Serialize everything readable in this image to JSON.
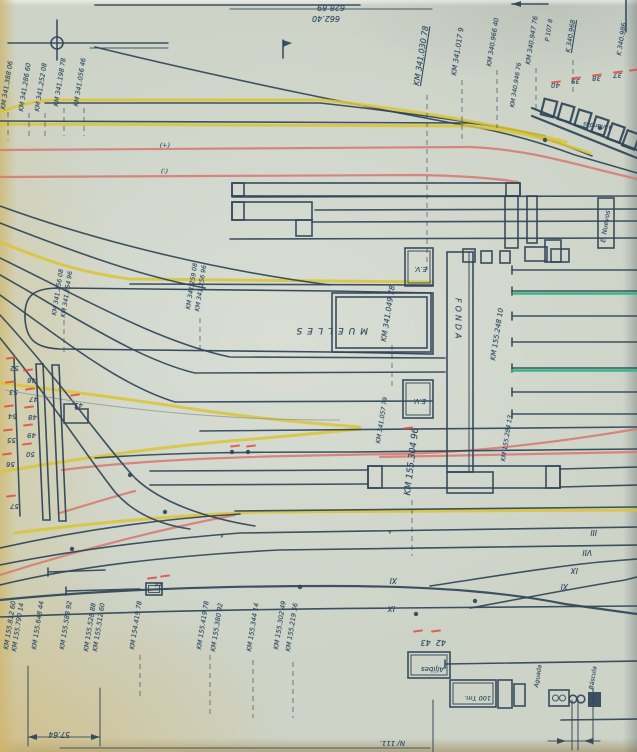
{
  "colors": {
    "ink": "#2e4a63",
    "track": "#2f4558",
    "yellow": "#d9c435",
    "salmon": "#d67c74",
    "red_mark": "#e04b44",
    "green": "#2fb383",
    "paper": "#cdd3c7",
    "pencil": "#8e9894"
  },
  "labels": [
    {
      "n": "dimension-value",
      "t": "628.89",
      "x": 345,
      "y": 11,
      "r": 180,
      "fs": 8
    },
    {
      "n": "dimension-value",
      "t": "662.40",
      "x": 340,
      "y": 22,
      "r": 180,
      "fs": 8
    },
    {
      "n": "km-marker",
      "t": "KM 341.388 06",
      "x": 0,
      "y": 109,
      "r": 279,
      "fs": 6.5
    },
    {
      "n": "km-marker",
      "t": "KM 341.286 60",
      "x": 18,
      "y": 111,
      "r": 279,
      "fs": 6.5
    },
    {
      "n": "km-marker",
      "t": "KM 341.252 08",
      "x": 34,
      "y": 111,
      "r": 279,
      "fs": 6.5
    },
    {
      "n": "km-marker",
      "t": "KM 341.198 78",
      "x": 53,
      "y": 106,
      "r": 279,
      "fs": 6.5
    },
    {
      "n": "km-marker",
      "t": "KM 341.056 46",
      "x": 73,
      "y": 106,
      "r": 279,
      "fs": 6.5
    },
    {
      "n": "km-marker",
      "t": "KM 341.030 78",
      "x": 413,
      "y": 85,
      "r": 279,
      "fs": 8,
      "u": true
    },
    {
      "n": "km-marker",
      "t": "KM 341.017 9",
      "x": 451,
      "y": 75,
      "r": 279,
      "fs": 7
    },
    {
      "n": "km-marker",
      "t": "KM 340.966 40",
      "x": 486,
      "y": 66,
      "r": 279,
      "fs": 6.5
    },
    {
      "n": "km-marker",
      "t": "KM 340.947 76",
      "x": 525,
      "y": 64,
      "r": 279,
      "fs": 6.5
    },
    {
      "n": "note",
      "t": "P 107 8",
      "x": 545,
      "y": 41,
      "r": 279,
      "fs": 6
    },
    {
      "n": "km-marker",
      "t": "K 340.968",
      "x": 565,
      "y": 52,
      "r": 279,
      "fs": 6.5,
      "u": true
    },
    {
      "n": "km-marker",
      "t": "KM 340.946 76",
      "x": 510,
      "y": 107,
      "r": 279,
      "fs": 6
    },
    {
      "n": "km-marker",
      "t": "K 340.986",
      "x": 616,
      "y": 55,
      "r": 279,
      "fs": 6.5
    },
    {
      "n": "destination-note",
      "t": "a Viandas",
      "x": 612,
      "y": 130,
      "r": 188,
      "fs": 6
    },
    {
      "n": "pier-number",
      "t": "40",
      "x": 560,
      "y": 88,
      "r": 180,
      "fs": 7
    },
    {
      "n": "pier-number",
      "t": "39",
      "x": 580,
      "y": 84,
      "r": 180,
      "fs": 7
    },
    {
      "n": "pier-number",
      "t": "38",
      "x": 601,
      "y": 81,
      "r": 180,
      "fs": 7
    },
    {
      "n": "pier-number",
      "t": "37",
      "x": 622,
      "y": 78,
      "r": 180,
      "fs": 7
    },
    {
      "n": "hand-mark",
      "t": "(+)",
      "x": 170,
      "y": 148,
      "r": 180,
      "fs": 6.5
    },
    {
      "n": "hand-mark",
      "t": "(:)",
      "x": 168,
      "y": 174,
      "r": 180,
      "fs": 6.5
    },
    {
      "n": "km-marker",
      "t": "KM 341.256 08",
      "x": 52,
      "y": 315,
      "r": 279,
      "fs": 6.2
    },
    {
      "n": "km-marker",
      "t": "KM 341.254 96",
      "x": 61,
      "y": 317,
      "r": 279,
      "fs": 6.2
    },
    {
      "n": "km-marker",
      "t": "KM 341.259 08",
      "x": 186,
      "y": 309,
      "r": 279,
      "fs": 6.2
    },
    {
      "n": "km-marker",
      "t": "KM 341.256 96",
      "x": 195,
      "y": 311,
      "r": 279,
      "fs": 6.2
    },
    {
      "n": "muelles-label",
      "t": "MUELLES",
      "x": 368,
      "y": 334,
      "r": 180,
      "fs": 9,
      "ls": 5
    },
    {
      "n": "km-marker",
      "t": "KM 341.049 78",
      "x": 380,
      "y": 341,
      "r": 279,
      "fs": 7.5
    },
    {
      "n": "fonda-label",
      "t": "FONDA",
      "x": 453,
      "y": 298,
      "vert": true,
      "fs": 8,
      "ls": 3
    },
    {
      "n": "ev-box-label",
      "t": "E.V.",
      "x": 427,
      "y": 272,
      "r": 180,
      "fs": 7
    },
    {
      "n": "ev-box-label",
      "t": "E.V.",
      "x": 426,
      "y": 404,
      "r": 180,
      "fs": 7
    },
    {
      "n": "km-marker",
      "t": "KM 155.248 10",
      "x": 490,
      "y": 360,
      "r": 279,
      "fs": 7
    },
    {
      "n": "building-label",
      "t": "E. Nuevos",
      "x": 600,
      "y": 242,
      "r": 279,
      "fs": 6.5
    },
    {
      "n": "km-marker",
      "t": "KM 341.057 79",
      "x": 376,
      "y": 443,
      "r": 279,
      "fs": 6.2
    },
    {
      "n": "km-marker",
      "t": "KM 155.304 96",
      "x": 404,
      "y": 495,
      "r": 277,
      "fs": 9
    },
    {
      "n": "km-marker",
      "t": "KM 155.284 13",
      "x": 501,
      "y": 461,
      "r": 279,
      "fs": 6.2
    },
    {
      "n": "switch-number",
      "t": "52",
      "x": 19,
      "y": 371,
      "r": 180,
      "fs": 7
    },
    {
      "n": "switch-number",
      "t": "53",
      "x": 18,
      "y": 395,
      "r": 180,
      "fs": 7
    },
    {
      "n": "switch-number",
      "t": "54",
      "x": 17,
      "y": 419,
      "r": 180,
      "fs": 7
    },
    {
      "n": "switch-number",
      "t": "55",
      "x": 16,
      "y": 443,
      "r": 180,
      "fs": 7
    },
    {
      "n": "switch-number",
      "t": "56",
      "x": 15,
      "y": 467,
      "r": 180,
      "fs": 7
    },
    {
      "n": "switch-number",
      "t": "57",
      "x": 19,
      "y": 509,
      "r": 180,
      "fs": 7
    },
    {
      "n": "switch-number",
      "t": "45",
      "x": 83,
      "y": 408,
      "r": 180,
      "fs": 7
    },
    {
      "n": "switch-number",
      "t": "46",
      "x": 36,
      "y": 383,
      "r": 180,
      "fs": 7
    },
    {
      "n": "switch-number",
      "t": "47",
      "x": 38,
      "y": 402,
      "r": 180,
      "fs": 7
    },
    {
      "n": "switch-number",
      "t": "48",
      "x": 37,
      "y": 420,
      "r": 180,
      "fs": 7
    },
    {
      "n": "switch-number",
      "t": "49",
      "x": 36,
      "y": 438,
      "r": 180,
      "fs": 7
    },
    {
      "n": "switch-number",
      "t": "50",
      "x": 35,
      "y": 457,
      "r": 180,
      "fs": 7
    },
    {
      "n": "switch-number",
      "t": "44",
      "x": 163,
      "y": 587,
      "r": 180,
      "fs": 6.5
    },
    {
      "n": "track-number-roman",
      "t": "III",
      "x": 597,
      "y": 536,
      "r": 180,
      "fs": 7.5
    },
    {
      "n": "track-number-roman",
      "t": "VII",
      "x": 592,
      "y": 556,
      "r": 180,
      "fs": 7.5
    },
    {
      "n": "track-number-roman",
      "t": "IX",
      "x": 578,
      "y": 574,
      "r": 180,
      "fs": 7.5
    },
    {
      "n": "track-number-roman",
      "t": "XI",
      "x": 568,
      "y": 590,
      "r": 180,
      "fs": 7.5
    },
    {
      "n": "track-number-roman",
      "t": "XI",
      "x": 397,
      "y": 584,
      "r": 180,
      "fs": 7.5
    },
    {
      "n": "track-number-roman",
      "t": "IX",
      "x": 395,
      "y": 612,
      "r": 180,
      "fs": 7.5
    },
    {
      "n": "hand-mark",
      "t": "∧",
      "x": 224,
      "y": 538,
      "r": 180,
      "fs": 6
    },
    {
      "n": "hand-mark",
      "t": "∧",
      "x": 392,
      "y": 534,
      "r": 180,
      "fs": 6
    },
    {
      "n": "km-marker",
      "t": "KM 155.812 60",
      "x": 3,
      "y": 649,
      "r": 279,
      "fs": 6.5
    },
    {
      "n": "km-marker",
      "t": "KM 155.790 14",
      "x": 11,
      "y": 651,
      "r": 279,
      "fs": 6.5
    },
    {
      "n": "km-marker",
      "t": "KM 155.648 44",
      "x": 31,
      "y": 649,
      "r": 279,
      "fs": 6.5
    },
    {
      "n": "km-marker",
      "t": "KM 155.588 92",
      "x": 59,
      "y": 649,
      "r": 279,
      "fs": 6.5
    },
    {
      "n": "km-marker",
      "t": "KM 155.528 88",
      "x": 83,
      "y": 651,
      "r": 279,
      "fs": 6.5
    },
    {
      "n": "km-marker",
      "t": "KM 155.512 60",
      "x": 92,
      "y": 651,
      "r": 279,
      "fs": 6.5
    },
    {
      "n": "km-marker",
      "t": "KM 154.419 78",
      "x": 129,
      "y": 649,
      "r": 279,
      "fs": 6.5
    },
    {
      "n": "km-marker",
      "t": "KM 155.419 78",
      "x": 196,
      "y": 649,
      "r": 279,
      "fs": 6.5
    },
    {
      "n": "km-marker",
      "t": "KM 155.380 92",
      "x": 210,
      "y": 651,
      "r": 279,
      "fs": 6.5
    },
    {
      "n": "km-marker",
      "t": "KM 155.344 14",
      "x": 246,
      "y": 651,
      "r": 279,
      "fs": 6.5
    },
    {
      "n": "km-marker",
      "t": "KM 155.302 49",
      "x": 273,
      "y": 649,
      "r": 279,
      "fs": 6.5
    },
    {
      "n": "km-marker",
      "t": "KM 155.219 56",
      "x": 285,
      "y": 651,
      "r": 279,
      "fs": 6.5
    },
    {
      "n": "switch-number",
      "t": "42  43",
      "x": 446,
      "y": 646,
      "r": 180,
      "fs": 8
    },
    {
      "n": "aljibes-label",
      "t": "Aljibes",
      "x": 444,
      "y": 672,
      "r": 180,
      "fs": 7
    },
    {
      "n": "weighbridge-label",
      "t": "100 Tm.",
      "x": 491,
      "y": 701,
      "r": 180,
      "fs": 6.5
    },
    {
      "n": "bascula-label",
      "t": "Báscula",
      "x": 589,
      "y": 689,
      "r": 279,
      "fs": 6
    },
    {
      "n": "aguada-label",
      "t": "Aguada",
      "x": 534,
      "y": 687,
      "r": 279,
      "fs": 6
    },
    {
      "n": "dimension-value",
      "t": "57.64",
      "x": 70,
      "y": 738,
      "r": 180,
      "fs": 7.5
    },
    {
      "n": "sheet-note",
      "t": "N/ 111.",
      "x": 405,
      "y": 746,
      "r": 180,
      "fs": 7
    }
  ],
  "red_ticks": [
    [
      551,
      81
    ],
    [
      571,
      77
    ],
    [
      592,
      74
    ],
    [
      613,
      71
    ],
    [
      629,
      69
    ],
    [
      6,
      357
    ],
    [
      5,
      381
    ],
    [
      4,
      405
    ],
    [
      3,
      429
    ],
    [
      2,
      453
    ],
    [
      6,
      495
    ],
    [
      70,
      394
    ],
    [
      23,
      369
    ],
    [
      25,
      388
    ],
    [
      24,
      406
    ],
    [
      23,
      424
    ],
    [
      22,
      443
    ],
    [
      403,
      427
    ],
    [
      230,
      445
    ],
    [
      246,
      445
    ],
    [
      147,
      577
    ],
    [
      160,
      575
    ],
    [
      413,
      630
    ],
    [
      431,
      630
    ]
  ]
}
